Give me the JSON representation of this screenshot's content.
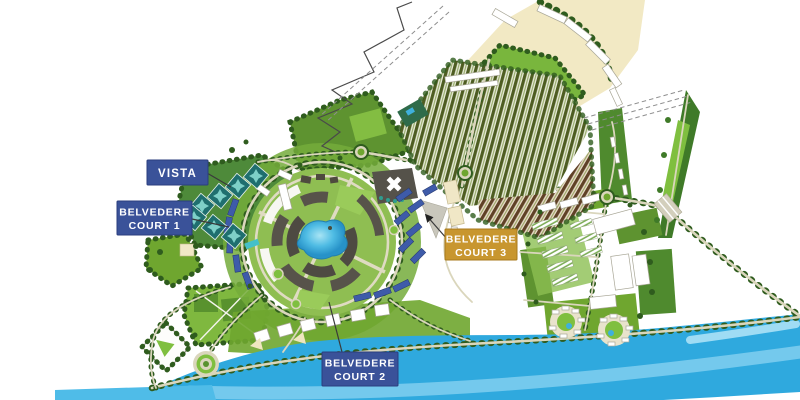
{
  "map": {
    "labels": {
      "vista": {
        "text": "VISTA"
      },
      "court1": {
        "line1": "BELVEDERE",
        "line2": "COURT 1"
      },
      "court2": {
        "line1": "BELVEDERE",
        "line2": "COURT 2"
      },
      "court3": {
        "line1": "BELVEDERE",
        "line2": "COURT 3"
      }
    },
    "colors": {
      "label_blue": "#3A5299",
      "label_blue_border": "#2B3E7E",
      "label_gold": "#C8962F",
      "label_gold_border": "#A87A1E",
      "label_text": "#FFFFFF",
      "river": "#2FA9DE",
      "river_highlight": "#7CCCEE",
      "lake": "#3FB4E2",
      "park_bright": "#7FBF3F",
      "park_mid": "#6FA62F",
      "park_dark": "#4F8A2E",
      "tree": "#2F5C1E",
      "road": "#DAD6BC",
      "beige_parcel": "#F2E9C4",
      "teal_building": "#1F6F6F",
      "blue_roof": "#3E5BA9",
      "dark_building": "#55524A",
      "white_building": "#FFFFFF"
    }
  }
}
